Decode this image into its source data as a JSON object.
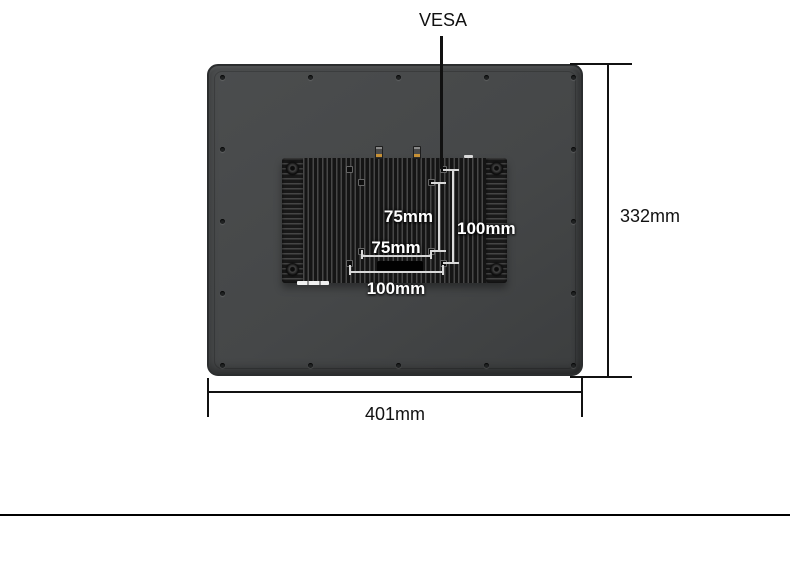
{
  "diagram": {
    "callout": {
      "label": "VESA"
    },
    "vesa_pattern": {
      "inner_vertical": "75mm",
      "inner_horizontal": "75mm",
      "outer_vertical": "100mm",
      "outer_horizontal": "100mm"
    },
    "overall": {
      "height": "332mm",
      "width": "401mm"
    },
    "colors": {
      "background": "#ffffff",
      "monitor_body": "#454748",
      "monitor_border": "#2b2d2e",
      "heatsink_fin_dark": "#151515",
      "heatsink_fin_light": "#474747",
      "dimension_line_dark": "#111111",
      "dimension_line_light": "#d9d9d9",
      "label_dark": "#111111",
      "label_light": "#ffffff",
      "connector_accent": "#c79136",
      "divider": "#000000"
    }
  }
}
